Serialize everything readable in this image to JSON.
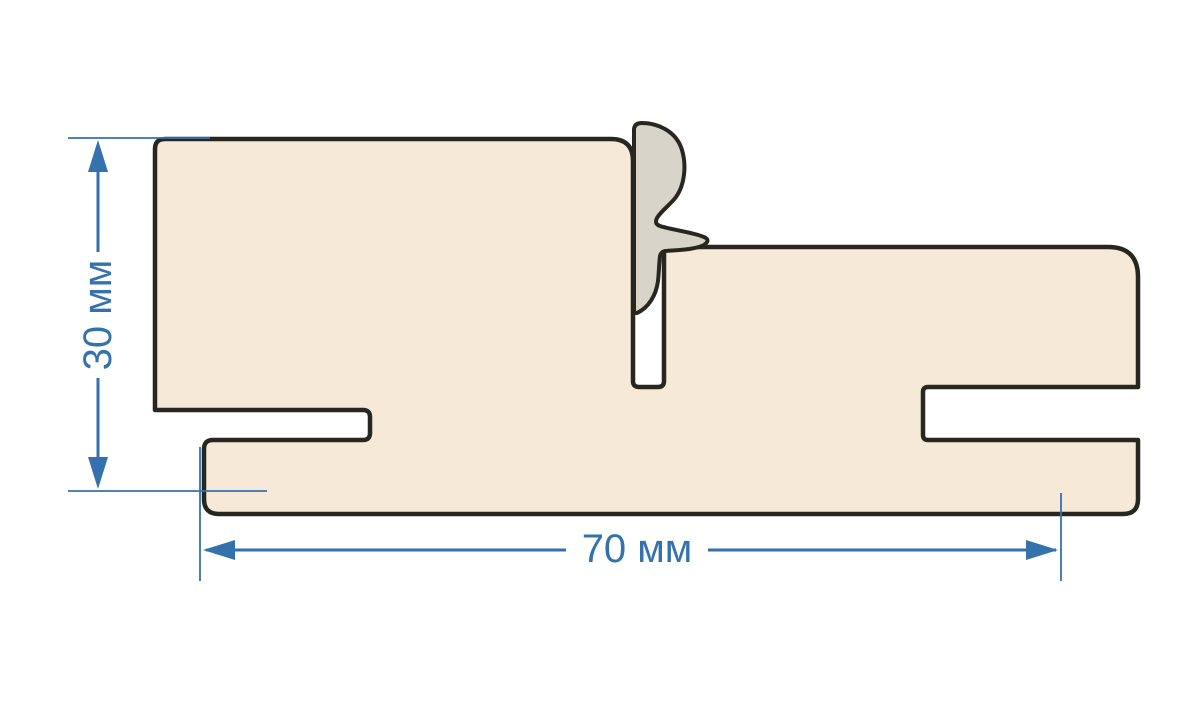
{
  "diagram": {
    "kind": "door-frame-profile-cross-section",
    "dimensions": {
      "height": {
        "value": 30,
        "unit": "мм",
        "label": "30 мм"
      },
      "width": {
        "value": 70,
        "unit": "мм",
        "label": "70 мм"
      }
    },
    "colors": {
      "background": "#ffffff",
      "profile_fill": "#f6e9d8",
      "seal_fill": "#d9d4c9",
      "outline": "#28271f",
      "dimension_blue": "#3372ad"
    }
  }
}
